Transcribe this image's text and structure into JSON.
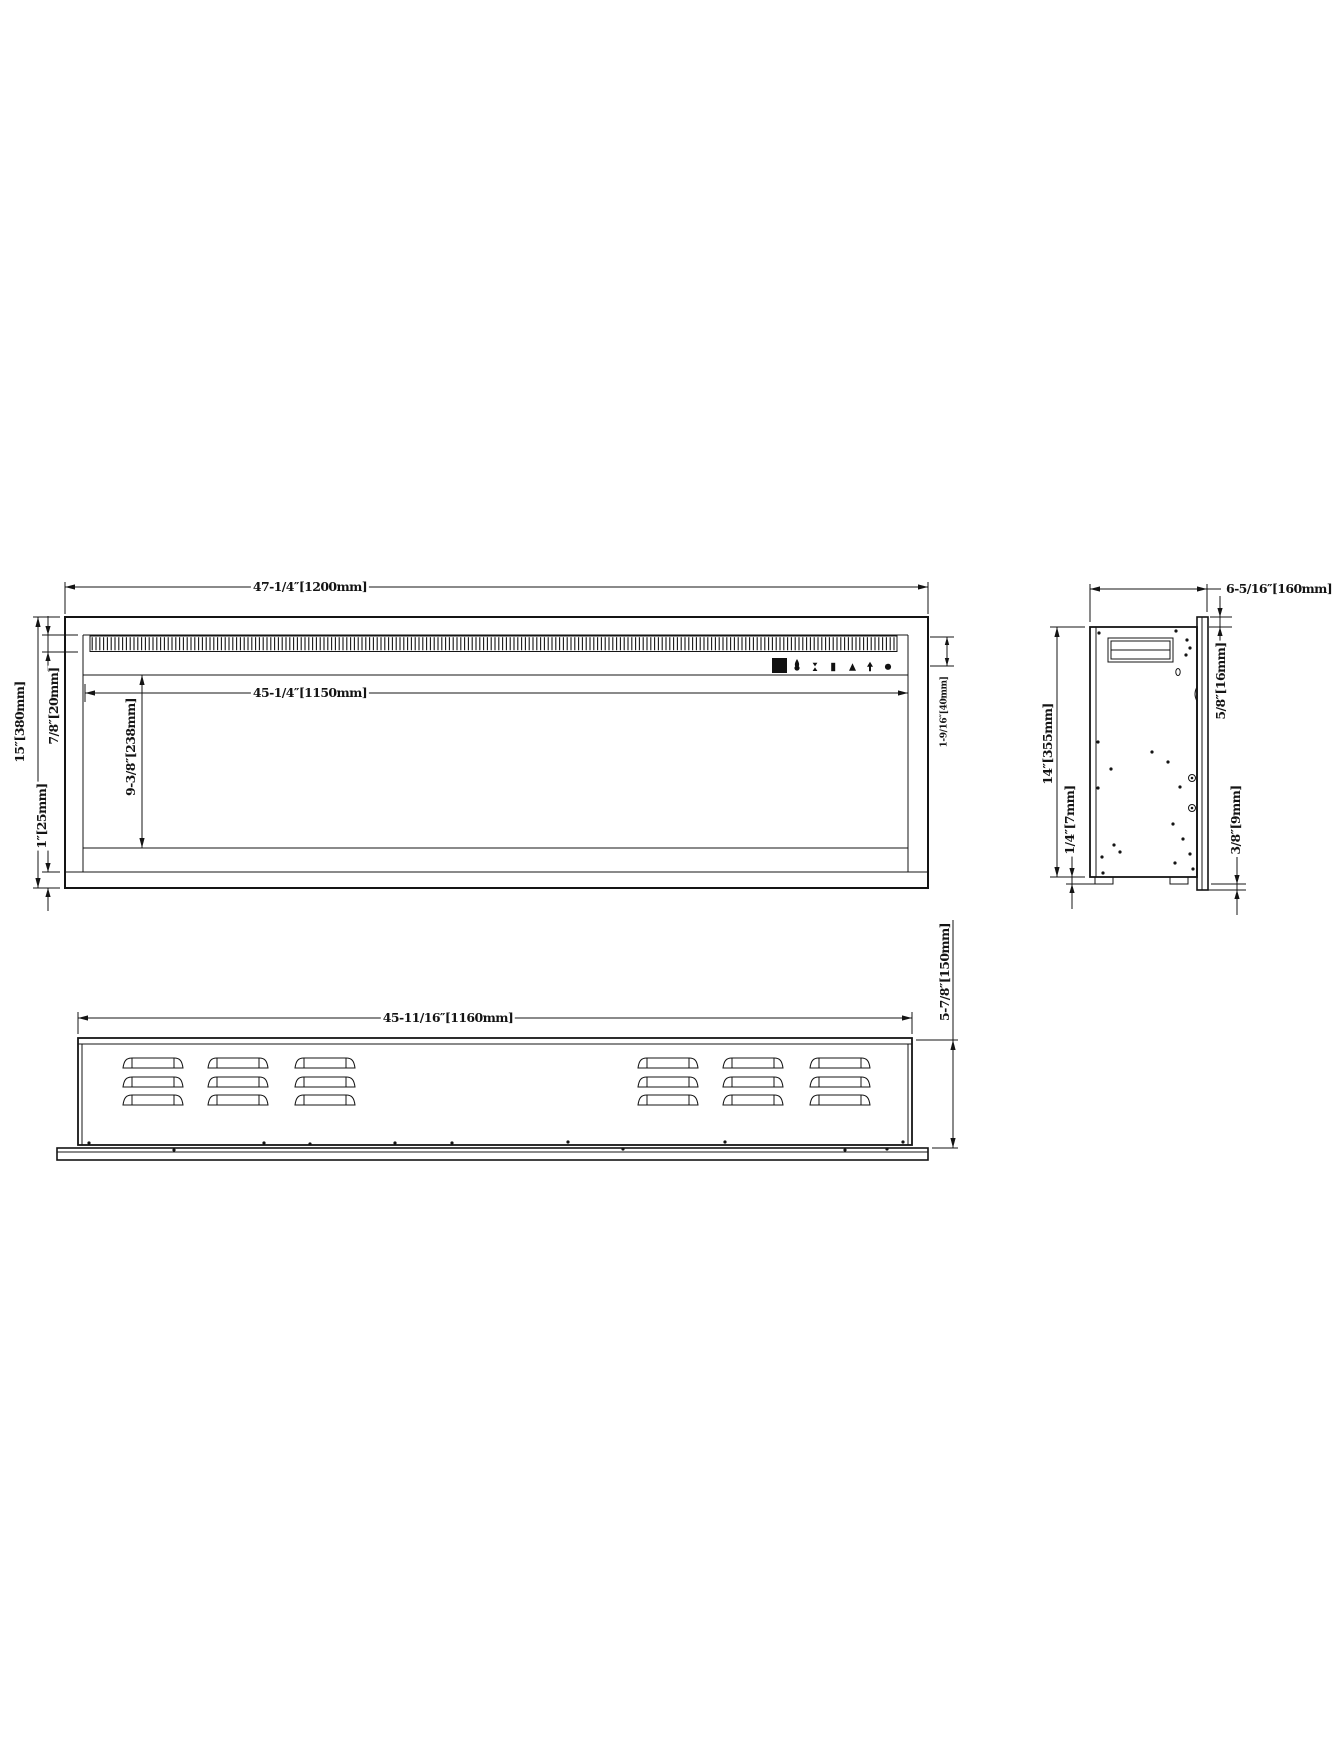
{
  "page": {
    "type": "technical-drawing",
    "colors": {
      "ink": "#141414",
      "paper": "#ffffff"
    }
  },
  "front_view": {
    "overall_width": "47-1/4″[1200mm]",
    "visible_width": "45-1/4″[1150mm]",
    "overall_height": "15″[380mm]",
    "grille_band_height": "7/8″[20mm]",
    "bottom_trim_height": "1″[25mm]",
    "opening_height": "9-3/8″[238mm]",
    "control_band_height": "1-9/16″[40mm]"
  },
  "side_view": {
    "overall_depth": "6-5/16″[160mm]",
    "body_height": "14″[355mm]",
    "front_flange_lip": "5/8″[16mm]",
    "foot_height": "1/4″[7mm]",
    "flange_overhang": "3/8″[9mm]"
  },
  "top_view": {
    "body_width": "45-11/16″[1160mm]",
    "body_depth": "5-7/8″[150mm]"
  },
  "control_panel": {
    "icons": [
      "display-window",
      "flame-icon",
      "mode-icon",
      "bar-icon",
      "triangle-up-icon",
      "arrow-up-icon",
      "power-icon"
    ]
  }
}
